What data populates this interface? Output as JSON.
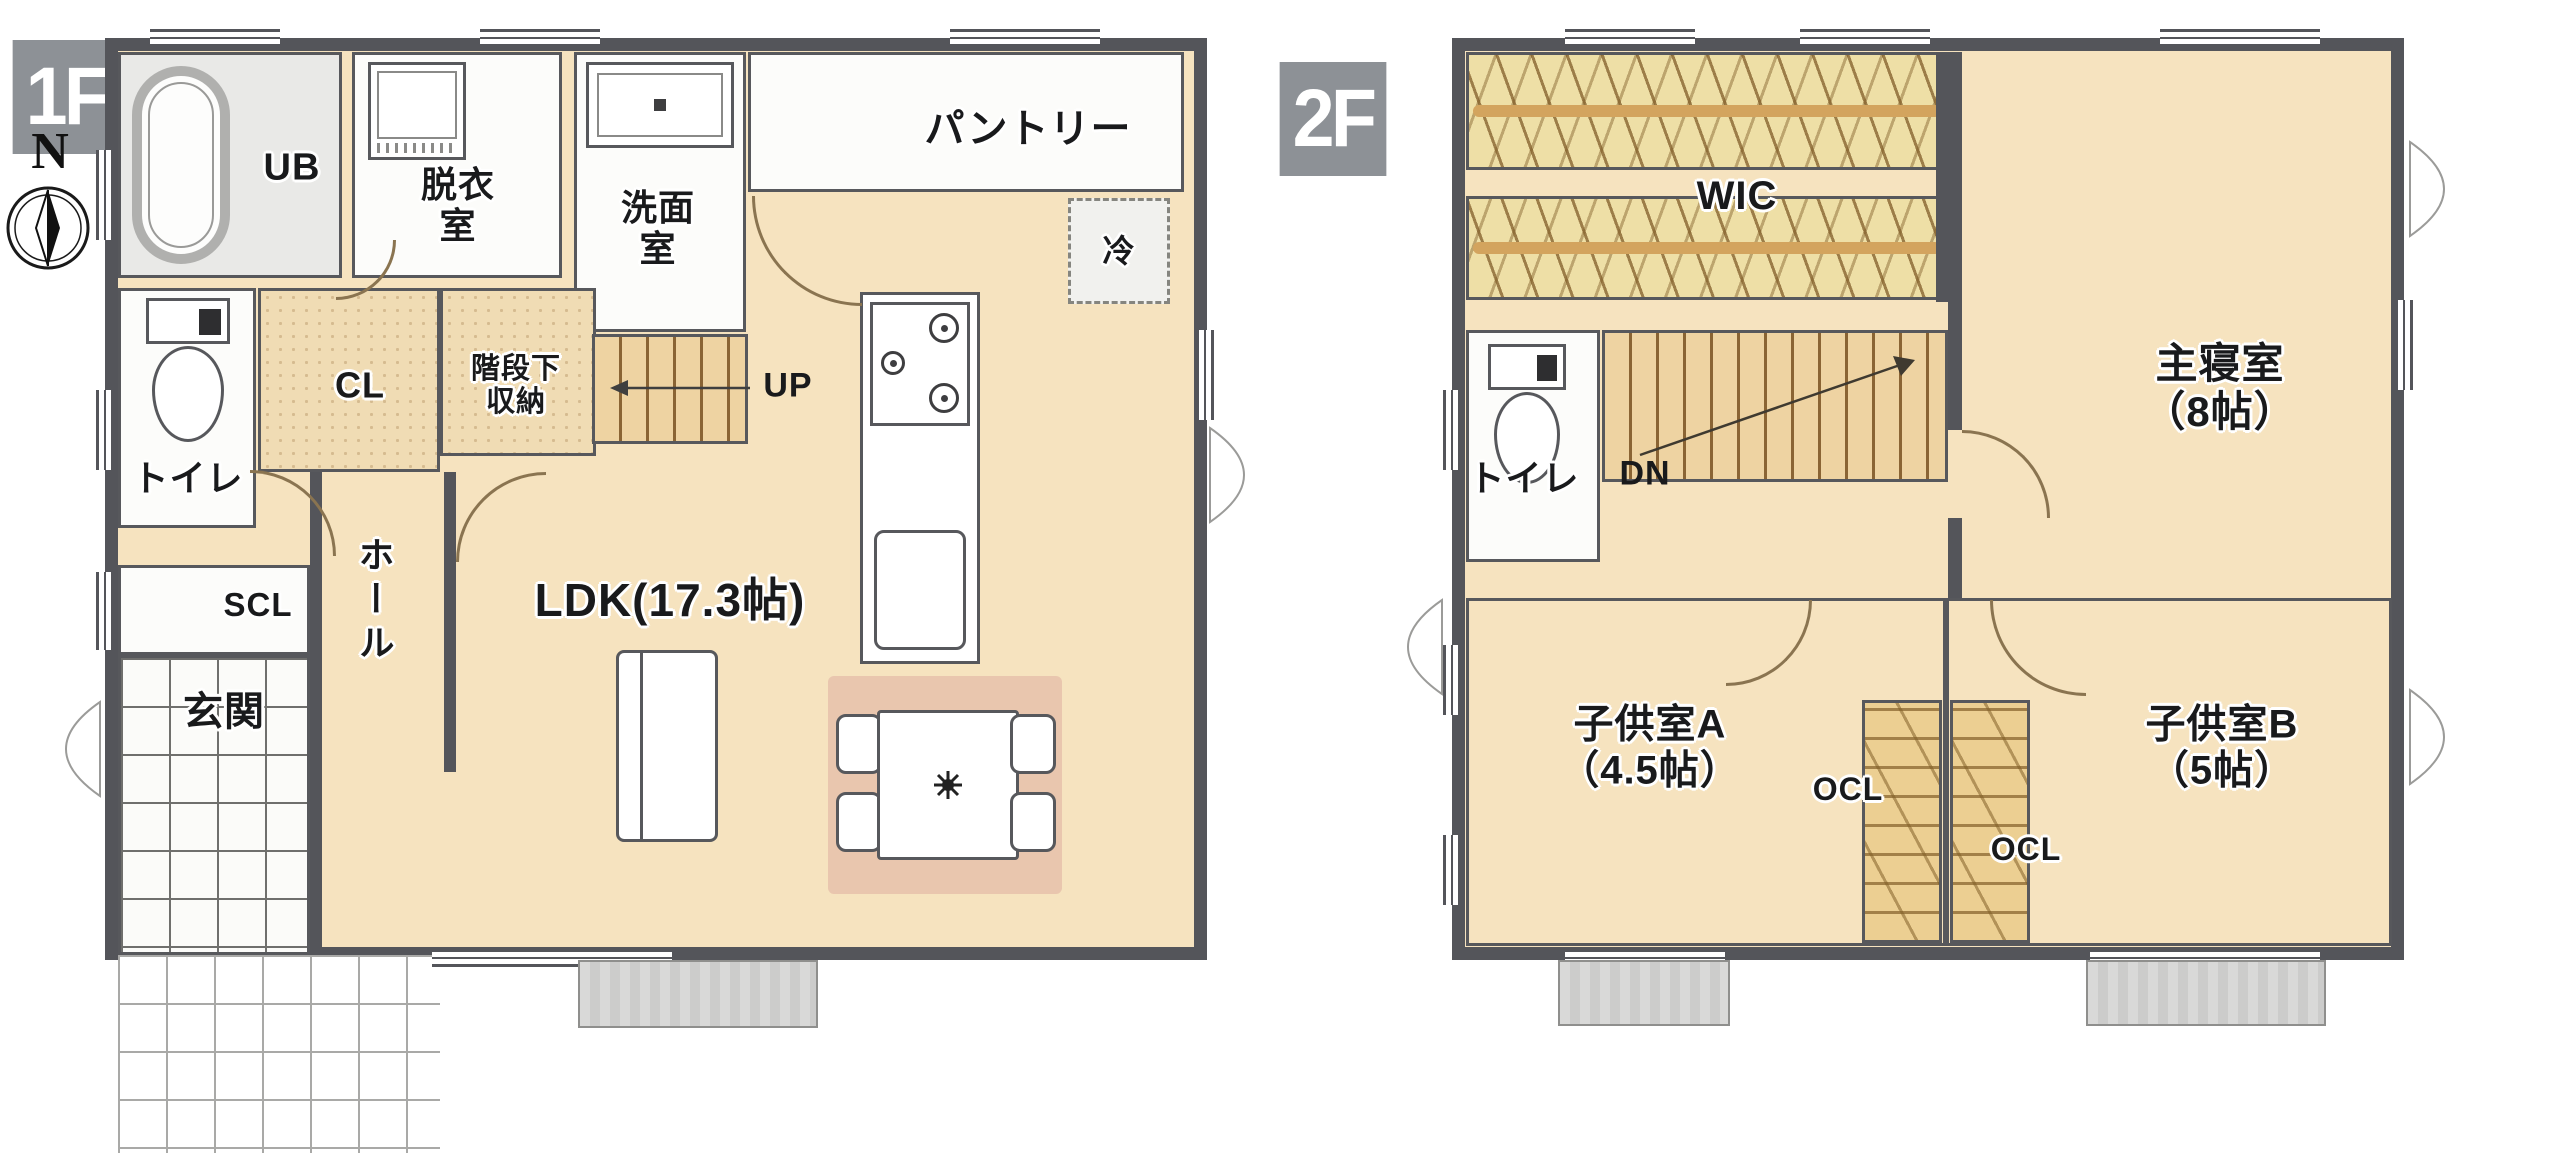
{
  "compass": {
    "north": "N"
  },
  "colors": {
    "wall": "#54555a",
    "floor_beige": "#f6e3bf",
    "badge_gray": "#8d9196",
    "storage_tan": "#f0dcb4",
    "stairs_tan": "#eed3a2",
    "deck_gray": "#cccccb",
    "dining_mat": "#e9c6ae"
  },
  "floors": [
    {
      "badge": "1F",
      "rooms": {
        "ub": "UB",
        "datsuishitsu": "脱衣\n室",
        "senmenshitsu": "洗面\n室",
        "pantry": "パントリー",
        "fridge": "冷",
        "closet": "CL",
        "under_stairs": "階段下\n収納",
        "stairs_up": "UP",
        "toilet": "トイレ",
        "shoe_closet": "SCL",
        "hall": "ホール",
        "entrance": "玄関",
        "ldk": "LDK(17.3帖)"
      }
    },
    {
      "badge": "2F",
      "rooms": {
        "wic": "WIC",
        "master_bedroom": "主寝室\n（8帖）",
        "toilet": "トイレ",
        "stairs_down": "DN",
        "kids_room_a": "子供室A\n（4.5帖）",
        "closet_a": "OCL",
        "closet_b": "OCL",
        "kids_room_b": "子供室B\n（5帖）"
      }
    }
  ]
}
